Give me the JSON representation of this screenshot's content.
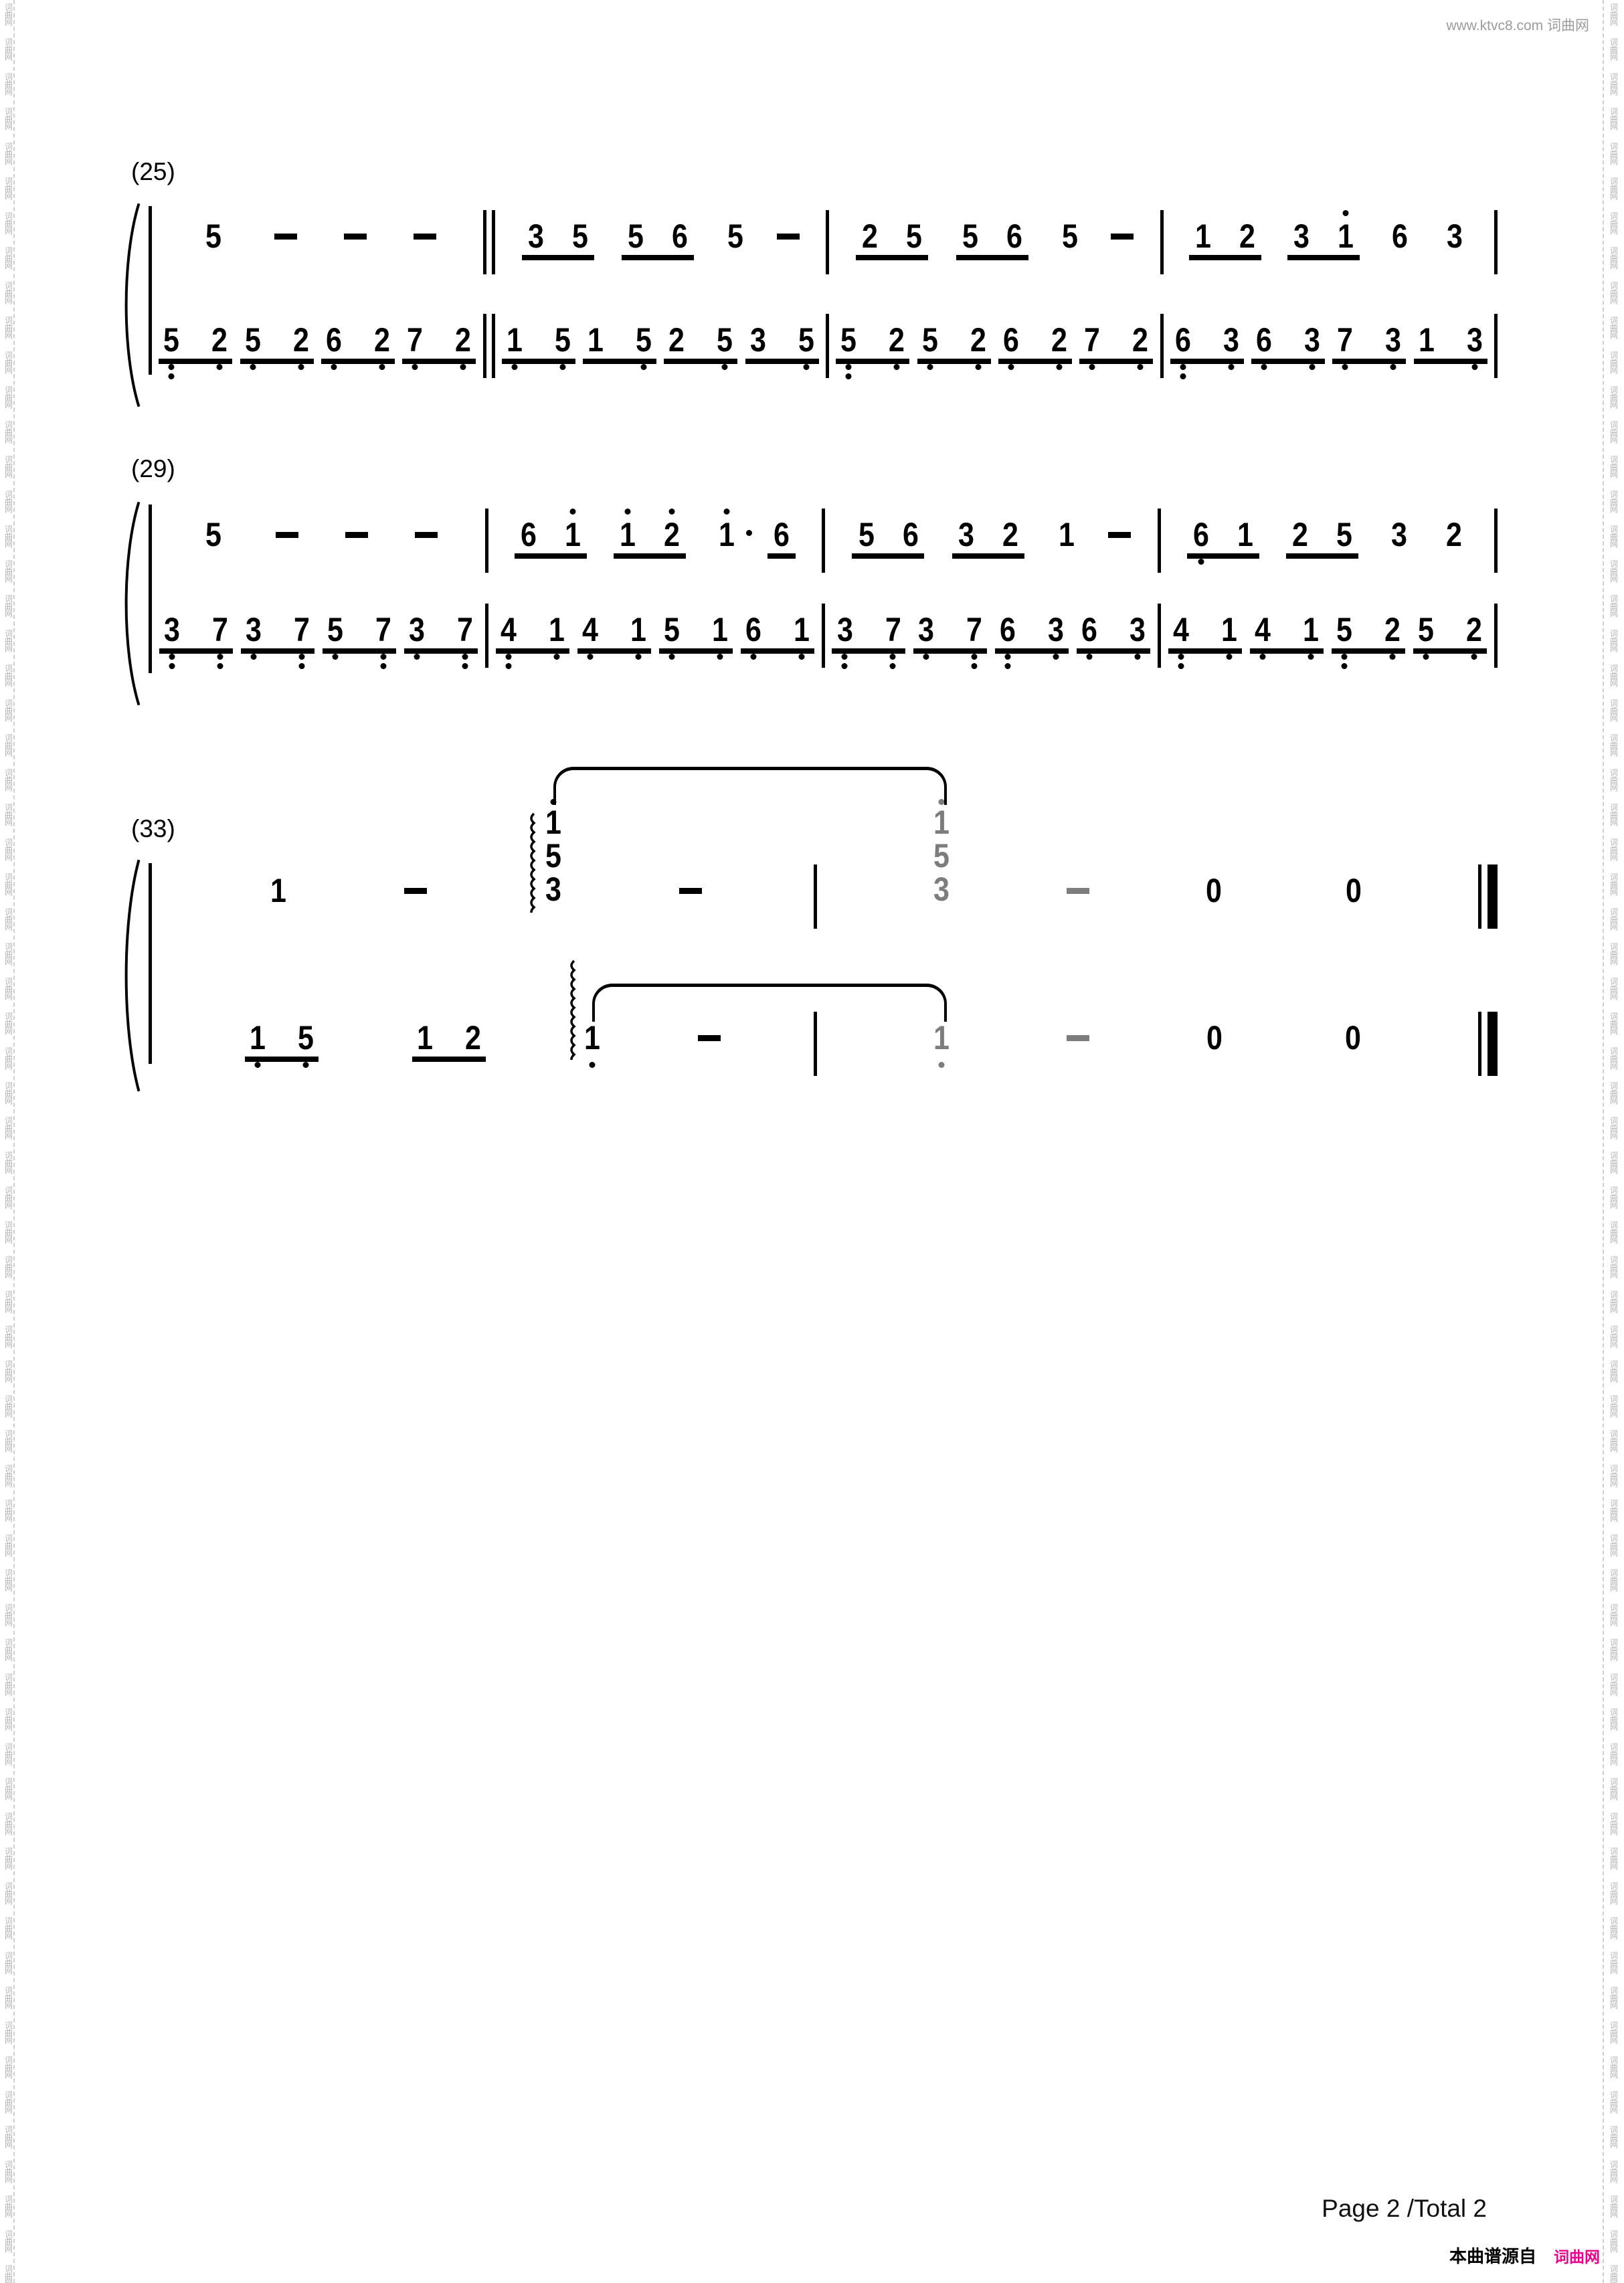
{
  "page": {
    "header_site": "www.ktvc8.com 词曲网",
    "footer_page": "Page 2 /Total 2",
    "footer_source_label": "本曲谱源自",
    "footer_source_site": "词曲网",
    "watermark_chars": [
      "词",
      "曲",
      "网"
    ],
    "colors": {
      "accent_pink": "#ec008c",
      "tied_gray": "#7d7d7d",
      "watermark_gray": "#b3b3b3"
    }
  },
  "score": {
    "systems": [
      {
        "label": "(25)",
        "separators": [
          "double",
          "single",
          "single"
        ],
        "end": "single",
        "top": [
          [
            {
              "t": "n",
              "d": "5"
            },
            {
              "t": "d"
            },
            {
              "t": "d"
            },
            {
              "t": "d"
            }
          ],
          [
            {
              "t": "p",
              "a": {
                "d": "3"
              },
              "b": {
                "d": "5"
              }
            },
            {
              "t": "p",
              "a": {
                "d": "5"
              },
              "b": {
                "d": "6"
              }
            },
            {
              "t": "n",
              "d": "5"
            },
            {
              "t": "d"
            }
          ],
          [
            {
              "t": "p",
              "a": {
                "d": "2"
              },
              "b": {
                "d": "5"
              }
            },
            {
              "t": "p",
              "a": {
                "d": "5"
              },
              "b": {
                "d": "6"
              }
            },
            {
              "t": "n",
              "d": "5"
            },
            {
              "t": "d"
            }
          ],
          [
            {
              "t": "p",
              "a": {
                "d": "1"
              },
              "b": {
                "d": "2"
              }
            },
            {
              "t": "p",
              "a": {
                "d": "3"
              },
              "b": {
                "d": "1",
                "hi": 1
              }
            },
            {
              "t": "n",
              "d": "6"
            },
            {
              "t": "n",
              "d": "3"
            }
          ]
        ],
        "bottom": [
          [
            {
              "t": "p",
              "a": {
                "d": "5",
                "lo": 2
              },
              "b": {
                "d": "2",
                "lo": 1
              }
            },
            {
              "t": "p",
              "a": {
                "d": "5",
                "lo": 1
              },
              "b": {
                "d": "2",
                "lo": 1
              }
            },
            {
              "t": "p",
              "a": {
                "d": "6",
                "lo": 1
              },
              "b": {
                "d": "2",
                "lo": 1
              }
            },
            {
              "t": "p",
              "a": {
                "d": "7",
                "lo": 1
              },
              "b": {
                "d": "2",
                "lo": 1
              }
            }
          ],
          [
            {
              "t": "p",
              "a": {
                "d": "1",
                "lo": 1
              },
              "b": {
                "d": "5",
                "lo": 1
              }
            },
            {
              "t": "p",
              "a": {
                "d": "1"
              },
              "b": {
                "d": "5",
                "lo": 1
              }
            },
            {
              "t": "p",
              "a": {
                "d": "2"
              },
              "b": {
                "d": "5",
                "lo": 1
              }
            },
            {
              "t": "p",
              "a": {
                "d": "3"
              },
              "b": {
                "d": "5",
                "lo": 1
              }
            }
          ],
          [
            {
              "t": "p",
              "a": {
                "d": "5",
                "lo": 2
              },
              "b": {
                "d": "2",
                "lo": 1
              }
            },
            {
              "t": "p",
              "a": {
                "d": "5",
                "lo": 1
              },
              "b": {
                "d": "2",
                "lo": 1
              }
            },
            {
              "t": "p",
              "a": {
                "d": "6",
                "lo": 1
              },
              "b": {
                "d": "2",
                "lo": 1
              }
            },
            {
              "t": "p",
              "a": {
                "d": "7",
                "lo": 1
              },
              "b": {
                "d": "2",
                "lo": 1
              }
            }
          ],
          [
            {
              "t": "p",
              "a": {
                "d": "6",
                "lo": 2
              },
              "b": {
                "d": "3",
                "lo": 1
              }
            },
            {
              "t": "p",
              "a": {
                "d": "6",
                "lo": 1
              },
              "b": {
                "d": "3",
                "lo": 1
              }
            },
            {
              "t": "p",
              "a": {
                "d": "7",
                "lo": 1
              },
              "b": {
                "d": "3",
                "lo": 1
              }
            },
            {
              "t": "p",
              "a": {
                "d": "1"
              },
              "b": {
                "d": "3",
                "lo": 1
              }
            }
          ]
        ]
      },
      {
        "label": "(29)",
        "separators": [
          "single",
          "single",
          "single"
        ],
        "end": "single",
        "top": [
          [
            {
              "t": "n",
              "d": "5"
            },
            {
              "t": "d"
            },
            {
              "t": "d"
            },
            {
              "t": "d"
            }
          ],
          [
            {
              "t": "p",
              "a": {
                "d": "6"
              },
              "b": {
                "d": "1",
                "hi": 1
              }
            },
            {
              "t": "p",
              "a": {
                "d": "1",
                "hi": 1
              },
              "b": {
                "d": "2",
                "hi": 1
              }
            },
            {
              "t": "n",
              "d": "1",
              "hi": 1,
              "aug": 1
            },
            {
              "t": "n",
              "d": "6",
              "u": 1
            }
          ],
          [
            {
              "t": "p",
              "a": {
                "d": "5"
              },
              "b": {
                "d": "6"
              }
            },
            {
              "t": "p",
              "a": {
                "d": "3"
              },
              "b": {
                "d": "2"
              }
            },
            {
              "t": "n",
              "d": "1"
            },
            {
              "t": "d"
            }
          ],
          [
            {
              "t": "p",
              "a": {
                "d": "6",
                "lo": 1
              },
              "b": {
                "d": "1"
              }
            },
            {
              "t": "p",
              "a": {
                "d": "2"
              },
              "b": {
                "d": "5"
              }
            },
            {
              "t": "n",
              "d": "3"
            },
            {
              "t": "n",
              "d": "2"
            }
          ]
        ],
        "bottom": [
          [
            {
              "t": "p",
              "a": {
                "d": "3",
                "lo": 2
              },
              "b": {
                "d": "7",
                "lo": 2
              }
            },
            {
              "t": "p",
              "a": {
                "d": "3",
                "lo": 1
              },
              "b": {
                "d": "7",
                "lo": 2
              }
            },
            {
              "t": "p",
              "a": {
                "d": "5",
                "lo": 1
              },
              "b": {
                "d": "7",
                "lo": 2
              }
            },
            {
              "t": "p",
              "a": {
                "d": "3",
                "lo": 1
              },
              "b": {
                "d": "7",
                "lo": 2
              }
            }
          ],
          [
            {
              "t": "p",
              "a": {
                "d": "4",
                "lo": 2
              },
              "b": {
                "d": "1",
                "lo": 1
              }
            },
            {
              "t": "p",
              "a": {
                "d": "4",
                "lo": 1
              },
              "b": {
                "d": "1",
                "lo": 1
              }
            },
            {
              "t": "p",
              "a": {
                "d": "5",
                "lo": 1
              },
              "b": {
                "d": "1",
                "lo": 1
              }
            },
            {
              "t": "p",
              "a": {
                "d": "6",
                "lo": 1
              },
              "b": {
                "d": "1",
                "lo": 1
              }
            }
          ],
          [
            {
              "t": "p",
              "a": {
                "d": "3",
                "lo": 2
              },
              "b": {
                "d": "7",
                "lo": 2
              }
            },
            {
              "t": "p",
              "a": {
                "d": "3",
                "lo": 1
              },
              "b": {
                "d": "7",
                "lo": 2
              }
            },
            {
              "t": "p",
              "a": {
                "d": "6",
                "lo": 2
              },
              "b": {
                "d": "3",
                "lo": 1
              }
            },
            {
              "t": "p",
              "a": {
                "d": "6",
                "lo": 1
              },
              "b": {
                "d": "3",
                "lo": 1
              }
            }
          ],
          [
            {
              "t": "p",
              "a": {
                "d": "4",
                "lo": 2
              },
              "b": {
                "d": "1",
                "lo": 1
              }
            },
            {
              "t": "p",
              "a": {
                "d": "4",
                "lo": 1
              },
              "b": {
                "d": "1",
                "lo": 1
              }
            },
            {
              "t": "p",
              "a": {
                "d": "5",
                "lo": 2
              },
              "b": {
                "d": "2",
                "lo": 1
              }
            },
            {
              "t": "p",
              "a": {
                "d": "5",
                "lo": 1
              },
              "b": {
                "d": "2",
                "lo": 1
              }
            }
          ]
        ]
      },
      {
        "label": "(33)",
        "separators": [
          "single"
        ],
        "end": "final",
        "top": [
          [
            {
              "t": "n",
              "d": "1"
            },
            {
              "t": "d"
            },
            {
              "t": "c",
              "notes": [
                {
                  "d": "1",
                  "hi": 1
                },
                {
                  "d": "5"
                },
                {
                  "d": "3"
                }
              ],
              "arp": 1,
              "tie": "start"
            },
            {
              "t": "d"
            }
          ],
          [
            {
              "t": "c",
              "notes": [
                {
                  "d": "1",
                  "hi": 1
                },
                {
                  "d": "5"
                },
                {
                  "d": "3"
                }
              ],
              "gray": 1,
              "tie": "end"
            },
            {
              "t": "d",
              "gray": 1
            },
            {
              "t": "n",
              "d": "0"
            },
            {
              "t": "n",
              "d": "0"
            }
          ]
        ],
        "bottom": [
          [
            {
              "t": "p",
              "a": {
                "d": "1",
                "lo": 1
              },
              "b": {
                "d": "5",
                "lo": 1
              }
            },
            {
              "t": "p",
              "a": {
                "d": "1"
              },
              "b": {
                "d": "2"
              }
            },
            {
              "t": "n",
              "d": "1",
              "lo": 1,
              "arp": 1,
              "tie": "start"
            },
            {
              "t": "d"
            }
          ],
          [
            {
              "t": "n",
              "d": "1",
              "lo": 1,
              "gray": 1,
              "tie": "end"
            },
            {
              "t": "d",
              "gray": 1
            },
            {
              "t": "n",
              "d": "0"
            },
            {
              "t": "n",
              "d": "0"
            }
          ]
        ]
      }
    ]
  }
}
